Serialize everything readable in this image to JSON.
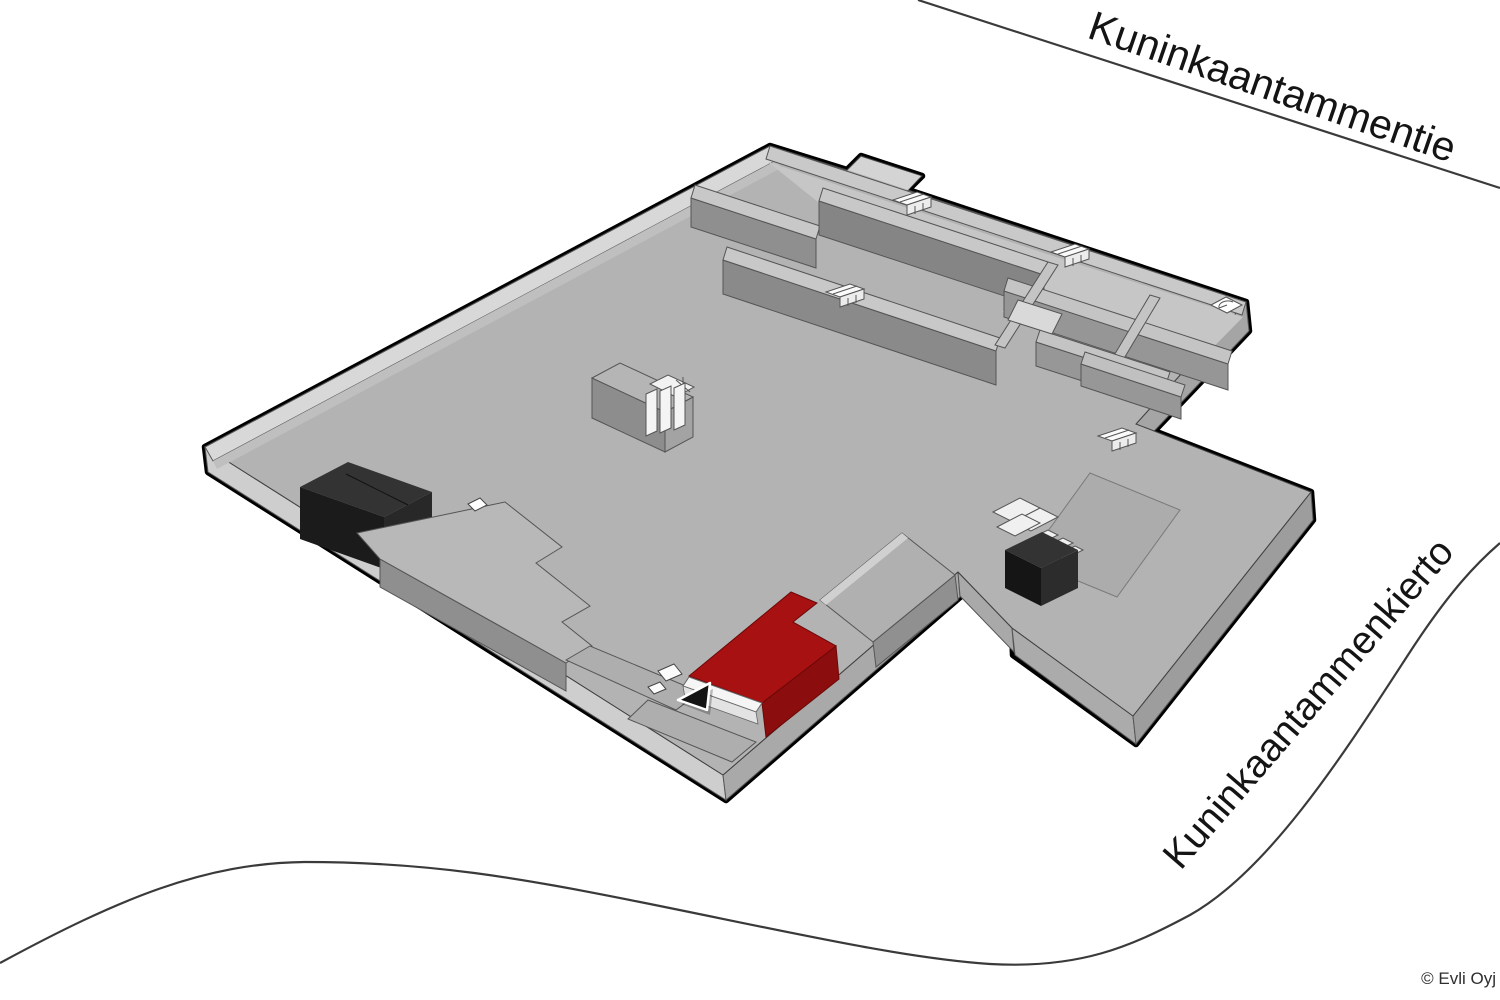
{
  "map": {
    "title": "Building floor map with highlighted unit",
    "streets": {
      "top": "Kuninkaantammentie",
      "bottom_right": "Kuninkaantammenkierto"
    },
    "copyright": "© Evli Oyj",
    "colors": {
      "background": "#ffffff",
      "road": "#3a3a3a",
      "outline": "#000000",
      "floor": "#b3b3b3",
      "wall_top": "#c8c8c8",
      "wall_side": "#8a8a8a",
      "black_block_top": "#333333",
      "dark_block_top": "#333333",
      "highlight_top": "#a81111",
      "highlight_side": "#8c0d0d",
      "marker": "#141414",
      "icon_white": "#fafafa"
    },
    "highlighted_unit": {
      "color": "#a81111",
      "status": "selected"
    },
    "icons": [
      "stairs-icon",
      "door-arc-icon",
      "location-arrow-icon",
      "service-tiles-icon"
    ]
  }
}
